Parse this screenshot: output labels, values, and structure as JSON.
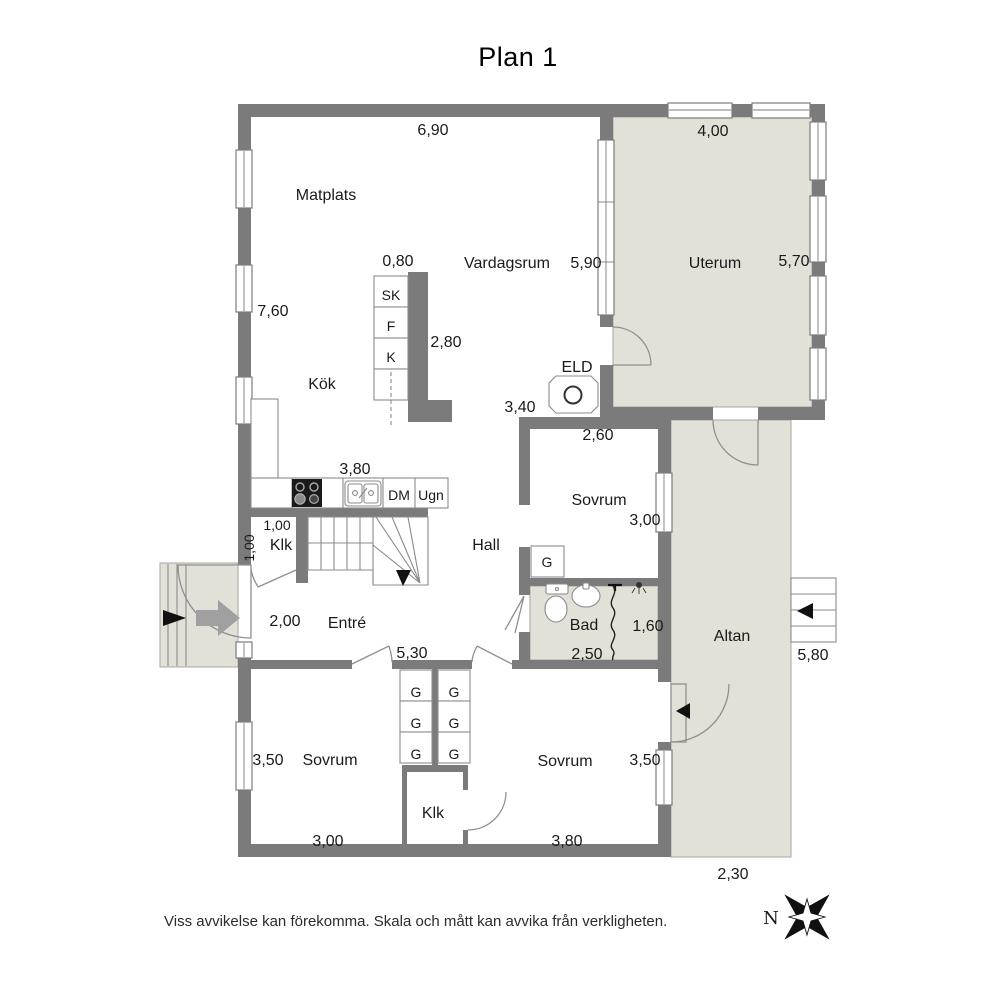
{
  "title": "Plan 1",
  "footer": "Viss avvikelse kan förekomma. Skala och mått kan avvika från verkligheten.",
  "compass": {
    "north": "N"
  },
  "plan": {
    "rooms": {
      "matplats": "Matplats",
      "vardagsrum": "Vardagsrum",
      "uterum": "Uterum",
      "kok": "Kök",
      "hall": "Hall",
      "entre": "Entré",
      "bad": "Bad",
      "altan": "Altan",
      "sovrum_mid": "Sovrum",
      "sovrum_left": "Sovrum",
      "sovrum_right": "Sovrum",
      "klk_upper": "Klk",
      "klk_lower": "Klk"
    },
    "fixtures": {
      "sk": "SK",
      "f": "F",
      "k": "K",
      "dm": "DM",
      "ugn": "Ugn",
      "eld": "ELD",
      "g": "G"
    },
    "dims": {
      "top_width": "6,90",
      "uterum_width": "4,00",
      "left_height": "7,60",
      "island_width": "0,80",
      "vardagsrum_height": "5,90",
      "uterum_height": "5,70",
      "island_length": "2,80",
      "opening_width": "3,40",
      "sovrum_mid_width": "2,60",
      "counter_length": "3,80",
      "sovrum_mid_height": "3,00",
      "klk_width": "1,00",
      "klk_depth": "1,00",
      "entrance_width": "2,00",
      "entre_width": "5,30",
      "shower_width": "1,60",
      "bad_width": "2,50",
      "altan_side": "5,80",
      "sovrum_left_height": "3,50",
      "sovrum_left_width": "3,00",
      "sovrum_right_height": "3,50",
      "sovrum_right_width": "3,80",
      "altan_width": "2,30"
    },
    "colors": {
      "wall": "#7b7b7b",
      "outdoor": "#e3e0d8",
      "line": "#8b8b8b"
    }
  }
}
